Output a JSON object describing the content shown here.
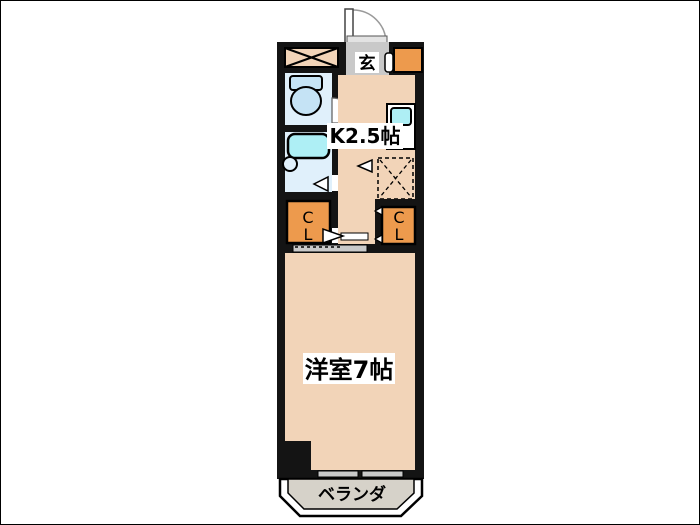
{
  "plan": {
    "labels": {
      "kitchen": "K2.5帖",
      "living_room": "洋室7帖",
      "entrance": "玄",
      "balcony": "ベランダ",
      "closet_left_line1": "C",
      "closet_left_line2": "L",
      "closet_right_line1": "C",
      "closet_right_line2": "L"
    },
    "colors": {
      "wall": "#141414",
      "floor": "#F2D4B8",
      "closet_orange": "#ED9A4D",
      "entrance_tile": "#C9C9C9",
      "balcony_gray": "#D6D2C9",
      "wet_floor": "#E0F0FB",
      "fixture_cyan": "#AEEFF5",
      "toilet_blue": "#C5E3F5",
      "counter_white": "#FFFFFF",
      "slider_gray": "#C9C9C9"
    }
  }
}
